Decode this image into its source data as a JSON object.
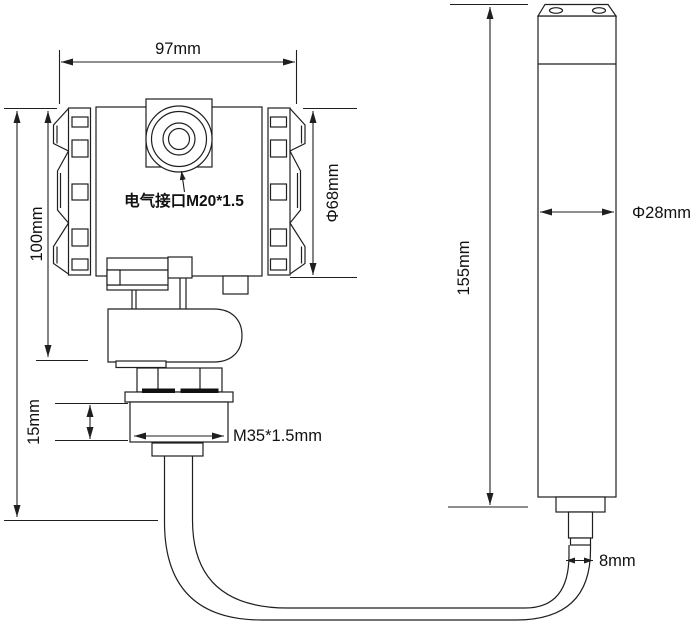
{
  "colors": {
    "background": "#ffffff",
    "line": "#1f1f1f",
    "text": "#111111",
    "gasket_fill": "#111111"
  },
  "drawing": {
    "transmitter": {
      "port_label": "电气接口M20*1.5",
      "dim_width": "97mm",
      "dim_height": "100mm",
      "dim_housing_diameter": "Φ68mm",
      "dim_gland_height": "15mm",
      "dim_thread": "M35*1.5mm"
    },
    "probe": {
      "dim_length": "155mm",
      "dim_diameter": "Φ28mm",
      "dim_cable_diameter": "8mm"
    }
  }
}
